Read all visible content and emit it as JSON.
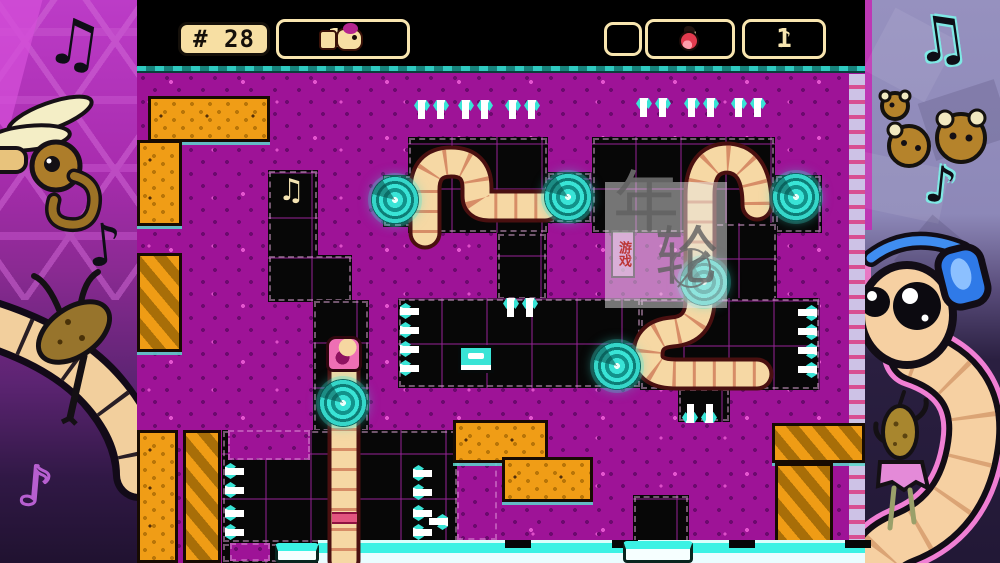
{
  "hud": {
    "level_badge": "# 28",
    "worm_count": "11",
    "apple_count": "0",
    "note_count": "1"
  },
  "icons": {
    "note_single": "♪",
    "note_double": "♫",
    "worm": "worm-icon",
    "apple": "apple-icon",
    "portal": "portal-swirl",
    "spike": "needle-spike"
  },
  "watermark": {
    "char1": "年",
    "char2": "轮",
    "tag": "游戏"
  },
  "colors": {
    "field_purple": "#a0149a",
    "tunnel_black": "#070707",
    "dirt_orange": "#f09d16",
    "accent_cyan": "#39e4d6",
    "hud_cream": "#f8e5af",
    "worm_body": "#f6d8a4",
    "worm_head_pink": "#ee6fb4",
    "ice_white": "#eafdff"
  },
  "level": {
    "black_regions": [
      {
        "x": 131,
        "y": 170,
        "w": 50,
        "h": 92
      },
      {
        "x": 131,
        "y": 255,
        "w": 84,
        "h": 47
      },
      {
        "x": 176,
        "y": 300,
        "w": 56,
        "h": 132
      },
      {
        "x": 271,
        "y": 137,
        "w": 140,
        "h": 96
      },
      {
        "x": 410,
        "y": 172,
        "w": 45,
        "h": 51
      },
      {
        "x": 455,
        "y": 137,
        "w": 183,
        "h": 96
      },
      {
        "x": 638,
        "y": 175,
        "w": 47,
        "h": 58
      },
      {
        "x": 558,
        "y": 223,
        "w": 82,
        "h": 80
      },
      {
        "x": 360,
        "y": 233,
        "w": 50,
        "h": 67
      },
      {
        "x": 261,
        "y": 298,
        "w": 243,
        "h": 90
      },
      {
        "x": 503,
        "y": 298,
        "w": 180,
        "h": 92
      },
      {
        "x": 541,
        "y": 388,
        "w": 52,
        "h": 34
      },
      {
        "x": 85,
        "y": 430,
        "w": 236,
        "h": 113
      },
      {
        "x": 496,
        "y": 495,
        "w": 56,
        "h": 48
      },
      {
        "x": 246,
        "y": 175,
        "w": 30,
        "h": 52
      },
      {
        "x": 85,
        "y": 543,
        "w": 96,
        "h": 20
      }
    ],
    "purple_insets": [
      {
        "x": 91,
        "y": 430,
        "w": 82,
        "h": 30
      },
      {
        "x": 93,
        "y": 543,
        "w": 40,
        "h": 18
      },
      {
        "x": 320,
        "y": 460,
        "w": 40,
        "h": 80
      }
    ],
    "orange_blocks": [
      {
        "x": 11,
        "y": 96,
        "w": 122,
        "h": 46,
        "style": "speckled"
      },
      {
        "x": 0,
        "y": 140,
        "w": 45,
        "h": 86,
        "style": "speckled"
      },
      {
        "x": 0,
        "y": 253,
        "w": 45,
        "h": 99,
        "style": "striped"
      },
      {
        "x": 316,
        "y": 420,
        "w": 95,
        "h": 43,
        "style": "speckled"
      },
      {
        "x": 365,
        "y": 457,
        "w": 91,
        "h": 45,
        "style": "speckled"
      },
      {
        "x": 635,
        "y": 423,
        "w": 93,
        "h": 40,
        "style": "striped"
      },
      {
        "x": 638,
        "y": 463,
        "w": 58,
        "h": 100,
        "style": "striped"
      },
      {
        "x": 0,
        "y": 430,
        "w": 41,
        "h": 133,
        "style": "speckled"
      },
      {
        "x": 46,
        "y": 430,
        "w": 38,
        "h": 133,
        "style": "striped"
      }
    ],
    "portals": [
      {
        "x": 258,
        "y": 200
      },
      {
        "x": 431,
        "y": 197
      },
      {
        "x": 659,
        "y": 197
      },
      {
        "x": 567,
        "y": 282
      },
      {
        "x": 480,
        "y": 366
      },
      {
        "x": 206,
        "y": 403
      }
    ],
    "spikes": [
      {
        "x": 277,
        "y": 100,
        "dir": "down",
        "n": 2
      },
      {
        "x": 321,
        "y": 100,
        "dir": "down",
        "n": 2
      },
      {
        "x": 368,
        "y": 100,
        "dir": "down",
        "n": 2
      },
      {
        "x": 499,
        "y": 98,
        "dir": "down",
        "n": 2
      },
      {
        "x": 547,
        "y": 98,
        "dir": "down",
        "n": 2
      },
      {
        "x": 594,
        "y": 98,
        "dir": "down",
        "n": 2
      },
      {
        "x": 263,
        "y": 303,
        "dir": "right",
        "n": 2
      },
      {
        "x": 263,
        "y": 341,
        "dir": "right",
        "n": 2
      },
      {
        "x": 366,
        "y": 298,
        "dir": "down",
        "n": 2
      },
      {
        "x": 640,
        "y": 305,
        "dir": "left",
        "n": 2
      },
      {
        "x": 640,
        "y": 343,
        "dir": "left",
        "n": 2
      },
      {
        "x": 88,
        "y": 463,
        "dir": "right",
        "n": 2
      },
      {
        "x": 88,
        "y": 505,
        "dir": "right",
        "n": 2
      },
      {
        "x": 276,
        "y": 465,
        "dir": "right",
        "n": 2
      },
      {
        "x": 276,
        "y": 505,
        "dir": "right",
        "n": 2
      },
      {
        "x": 545,
        "y": 383,
        "dir": "up",
        "n": 2
      },
      {
        "x": 271,
        "y": 514,
        "dir": "left",
        "n": 1
      }
    ],
    "worms": [
      {
        "d": "M 288 233 L 288 190 Q 288 162 314 162 Q 340 162 340 188 L 340 196 Q 340 206 352 206 L 408 206"
      },
      {
        "d": "M 620 205 Q 620 160 591 158 Q 563 158 563 195 L 563 300 Q 563 330 535 332 Q 511 334 511 355 Q 511 374 539 374 L 620 374"
      },
      {
        "d": "M 207 368 L 207 560"
      }
    ],
    "worm_head": {
      "x": 189,
      "y": 336
    },
    "worm_band": {
      "x": 195,
      "y": 512,
      "w": 25,
      "h": 12
    },
    "pickup_note": {
      "x": 141,
      "y": 176
    },
    "ice": {
      "ledge": {
        "x": 181,
        "y": 540,
        "w": 547,
        "h": 13
      },
      "white": {
        "x": 181,
        "y": 553,
        "w": 547,
        "h": 10
      },
      "notches": [
        368,
        475,
        592,
        708
      ],
      "boxes": [
        {
          "x": 138,
          "y": 543,
          "w": 44,
          "h": 20
        },
        {
          "x": 486,
          "y": 541,
          "w": 70,
          "h": 22
        }
      ],
      "item_box": {
        "x": 321,
        "y": 345,
        "w": 36,
        "h": 28
      }
    },
    "rail": {
      "x": 712,
      "y": 74,
      "w": 16,
      "h": 489
    }
  }
}
